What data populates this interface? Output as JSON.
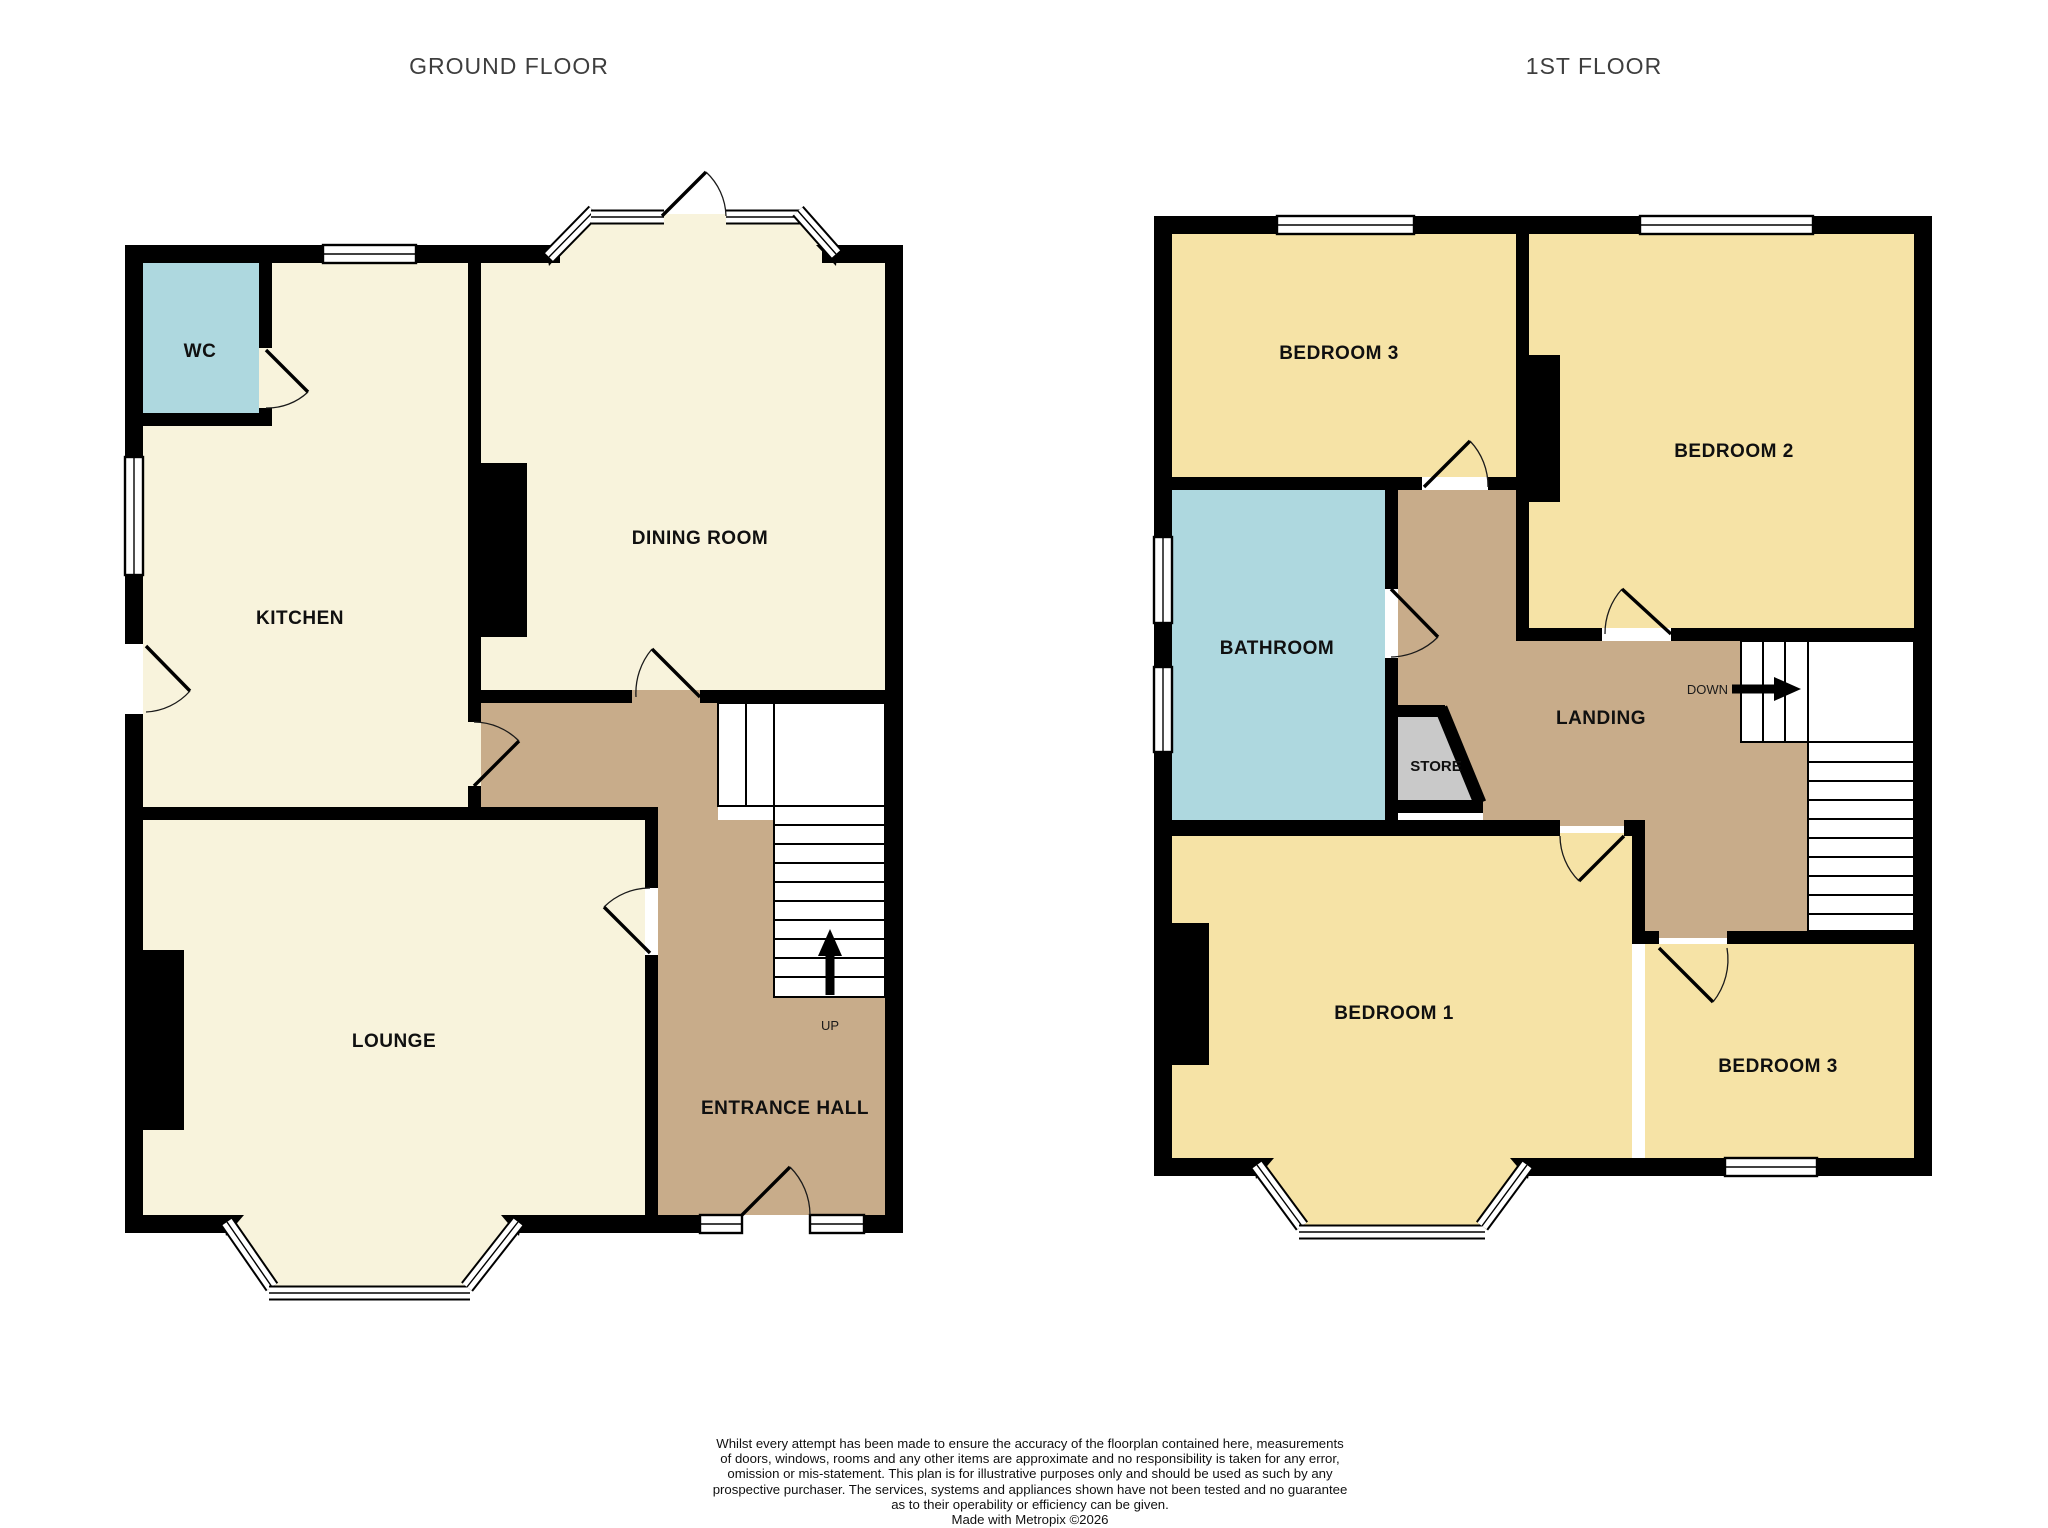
{
  "titles": {
    "ground_floor": "GROUND FLOOR",
    "first_floor": "1ST FLOOR"
  },
  "ground_floor": {
    "rooms": {
      "wc": "WC",
      "kitchen": "KITCHEN",
      "dining_room": "DINING ROOM",
      "lounge": "LOUNGE",
      "entrance_hall": "ENTRANCE HALL"
    },
    "stairs_label": "UP"
  },
  "first_floor": {
    "rooms": {
      "bedroom3_top": "BEDROOM 3",
      "bedroom2": "BEDROOM 2",
      "bathroom": "BATHROOM",
      "store": "STORE",
      "landing": "LANDING",
      "bedroom1": "BEDROOM 1",
      "bedroom3_bottom": "BEDROOM 3"
    },
    "stairs_label": "DOWN"
  },
  "footer": {
    "lines": [
      "Whilst every attempt has been made to ensure the accuracy of the floorplan contained here, measurements",
      "of doors, windows, rooms and any other items are approximate and no responsibility is taken for any error,",
      "omission or mis-statement. This plan is for illustrative purposes only and should be used as such by any",
      "prospective purchaser. The services, systems and appliances shown have not been tested and no guarantee",
      "as to their operability or efficiency can be given.",
      "Made with Metropix ©2026"
    ]
  },
  "colors": {
    "wall": "#000000",
    "ground_room_cream": "#F8F3DC",
    "bedroom_yellow": "#F6E3A6",
    "wet_room_blue": "#AED8DF",
    "hall_landing_tan": "#C8AC8A",
    "store_gray": "#C9C9C9",
    "background": "#FFFFFF"
  }
}
